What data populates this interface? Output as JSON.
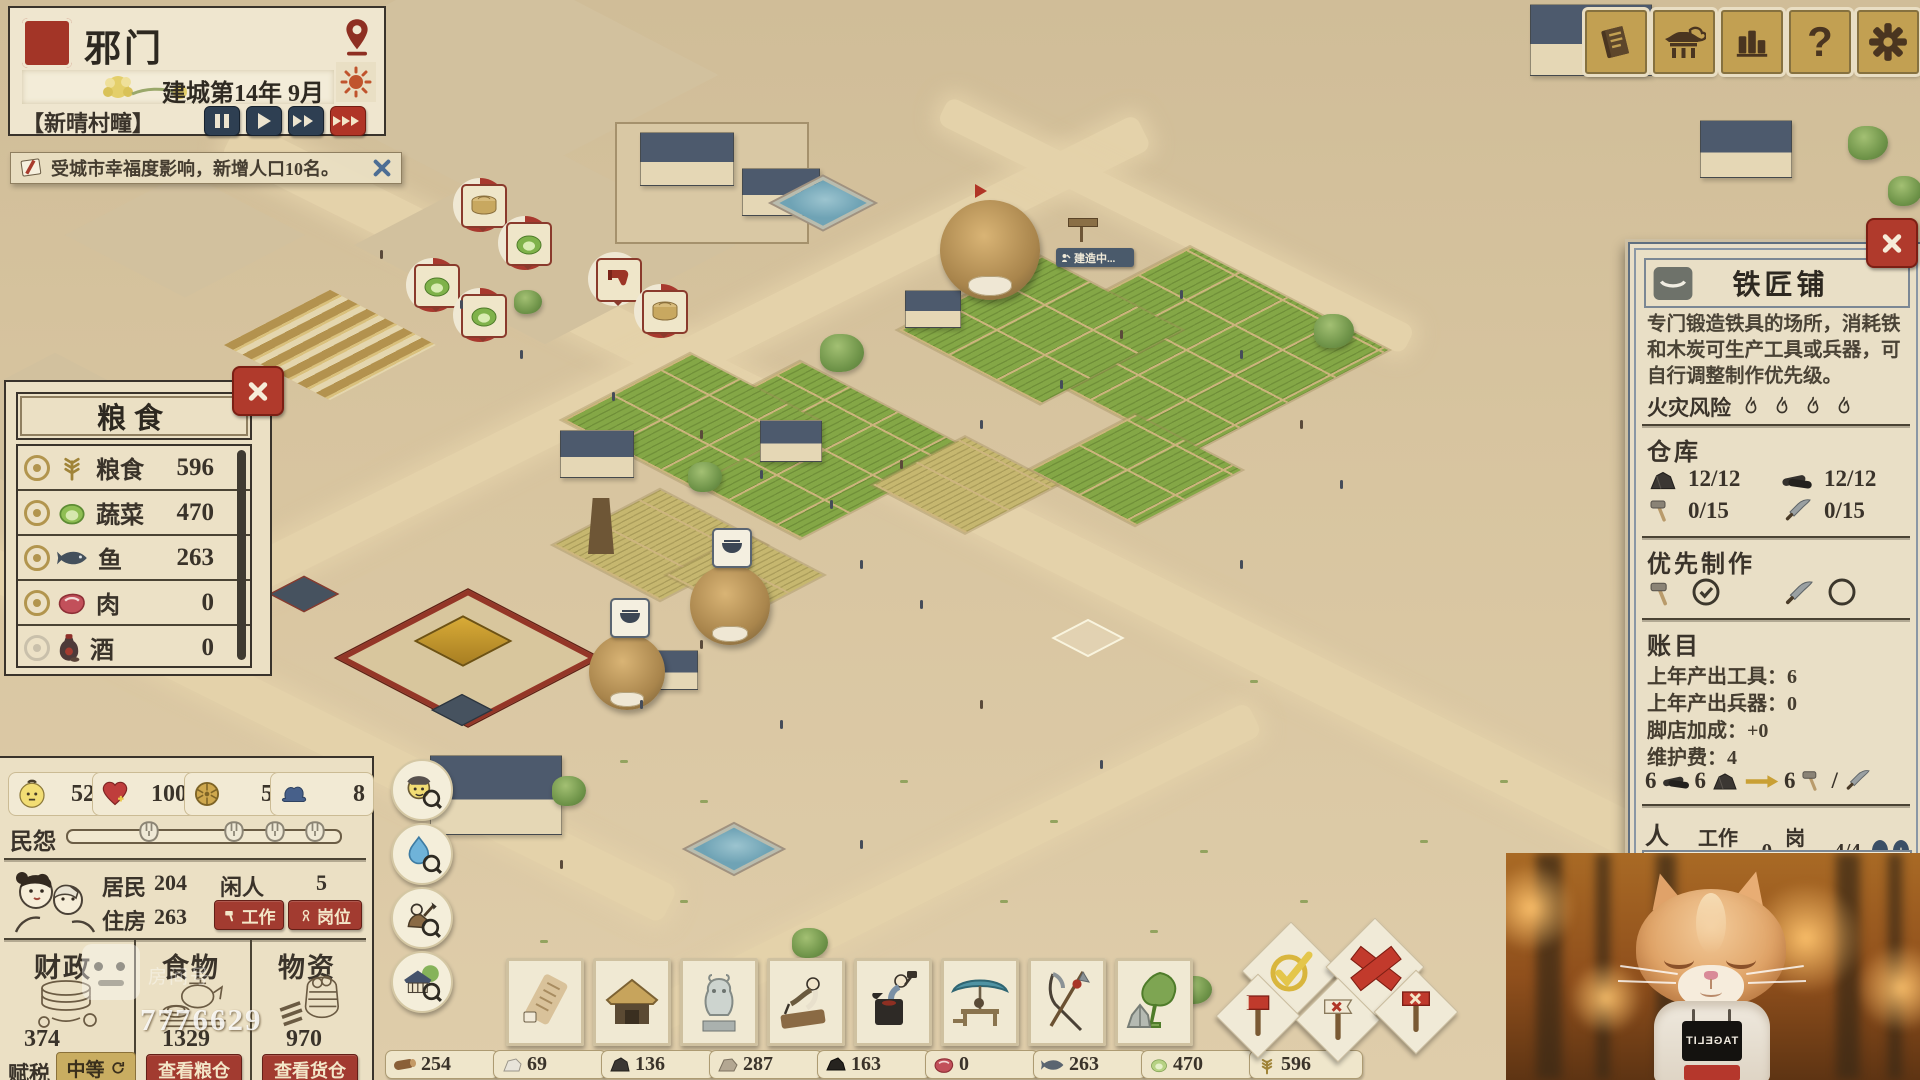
{
  "header": {
    "city_name": "邪门",
    "date": "建城第14年 9月",
    "weather": "【新晴村疃】"
  },
  "notification": {
    "text": "受城市幸福度影响，新增人口10名。"
  },
  "food_panel": {
    "title": "粮食",
    "rows": [
      {
        "icon": "grain-icon",
        "name": "粮食",
        "value": "596"
      },
      {
        "icon": "vegetable-icon",
        "name": "蔬菜",
        "value": "470"
      },
      {
        "icon": "fish-icon",
        "name": "鱼",
        "value": "263"
      },
      {
        "icon": "meat-icon",
        "name": "肉",
        "value": "0"
      },
      {
        "icon": "wine-icon",
        "name": "酒",
        "value": "0"
      }
    ]
  },
  "stats_panel": {
    "population": "52",
    "happiness": "100",
    "coin": "5",
    "officials": "8",
    "grievance_label": "民怨",
    "residents_label": "居民",
    "residents": "204",
    "idle_label": "闲人",
    "idle": "5",
    "housing_label": "住房",
    "housing": "263",
    "work_button": "工作",
    "post_button": "岗位",
    "finance_title": "财政",
    "finance_value": "374",
    "food_title": "食物",
    "food_value": "1329",
    "granary_button": "查看粮仓",
    "goods_title": "物资",
    "goods_value": "970",
    "warehouse_button": "查看货仓",
    "tax_label": "赋税",
    "tax_value": "中等"
  },
  "blacksmith_panel": {
    "title": "铁匠铺",
    "description": "专门锻造铁具的场所，消耗铁和木炭可生产工具或兵器，可自行调整制作优先级。",
    "fire_risk_label": "火灾风险",
    "warehouse_title": "仓库",
    "iron_stock": "12/12",
    "charcoal_stock": "12/12",
    "tool_stock": "0/15",
    "weapon_stock": "0/15",
    "priority_title": "优先制作",
    "ledger_title": "账目",
    "ledger_lines": [
      "上年产出工具：6",
      "上年产出兵器：0",
      "脚店加成：+0",
      "维护费：4"
    ],
    "formula": {
      "charcoal": "6",
      "iron": "6",
      "output": "6",
      "separator": "/"
    },
    "staff_title": "人员",
    "working_label": "工作中：",
    "working": "0",
    "slots_label": "岗位：",
    "slots": "4/4",
    "minus": "−",
    "plus": "+"
  },
  "world": {
    "construction": "建造中..."
  },
  "resource_bar": [
    {
      "name": "wood",
      "value": "254"
    },
    {
      "name": "stone",
      "value": "69"
    },
    {
      "name": "iron",
      "value": "136"
    },
    {
      "name": "clay",
      "value": "287"
    },
    {
      "name": "charcoal",
      "value": "163"
    },
    {
      "name": "meat",
      "value": "0"
    },
    {
      "name": "fish",
      "value": "263"
    },
    {
      "name": "vegetable",
      "value": "470"
    },
    {
      "name": "grain",
      "value": "596"
    }
  ],
  "watermark": {
    "room_label": "房间号",
    "room": "7776629"
  },
  "facecam": {
    "shirt": "TAGELIT"
  }
}
